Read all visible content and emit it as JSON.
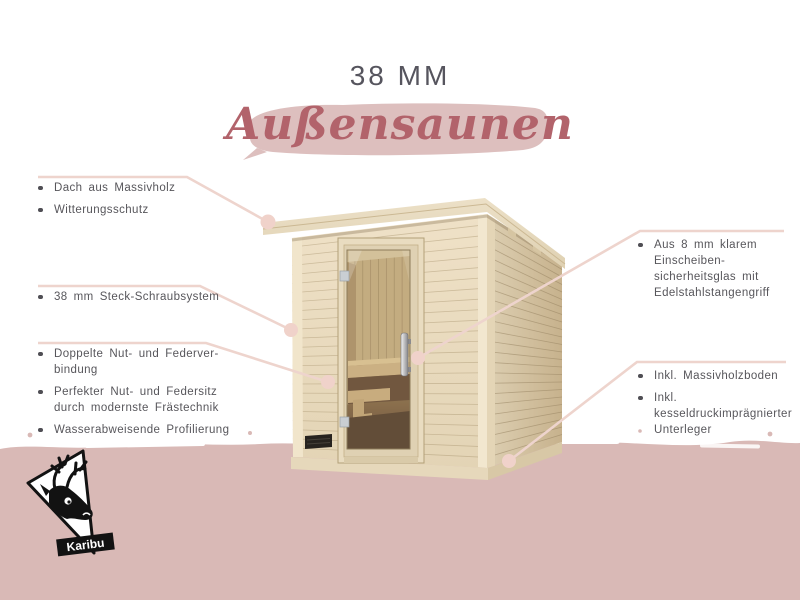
{
  "header": {
    "thickness": "38 MM",
    "product": "Außensaunen"
  },
  "features_left": [
    {
      "items": [
        "Dach aus Massivholz",
        "Witterungsschutz"
      ]
    },
    {
      "items": [
        "38 mm Steck-Schraubsystem"
      ]
    },
    {
      "items": [
        "Doppelte Nut- und Federver-\nbindung",
        "Perfekter Nut- und Federsitz\ndurch modernste Frästechnik",
        "Wasserabweisende Profilierung"
      ]
    }
  ],
  "features_right": [
    {
      "items": [
        "Aus 8 mm klarem Einscheiben-\nsicherheitsglas mit\nEdelstahlstangengriff"
      ]
    },
    {
      "items": [
        "Inkl. Massivholzboden",
        "Inkl. kesseldruckimprägnierter\nUnterleger"
      ]
    }
  ],
  "logo": {
    "brand": "Karibu",
    "icon": "deer-icon"
  },
  "colors": {
    "band": "#d9b9b6",
    "brush": "#ddbfbe",
    "script": "#b2636b",
    "title": "#56555e",
    "text": "#57565b",
    "line": "#eed4cd",
    "dot": "#f0d2ca"
  }
}
